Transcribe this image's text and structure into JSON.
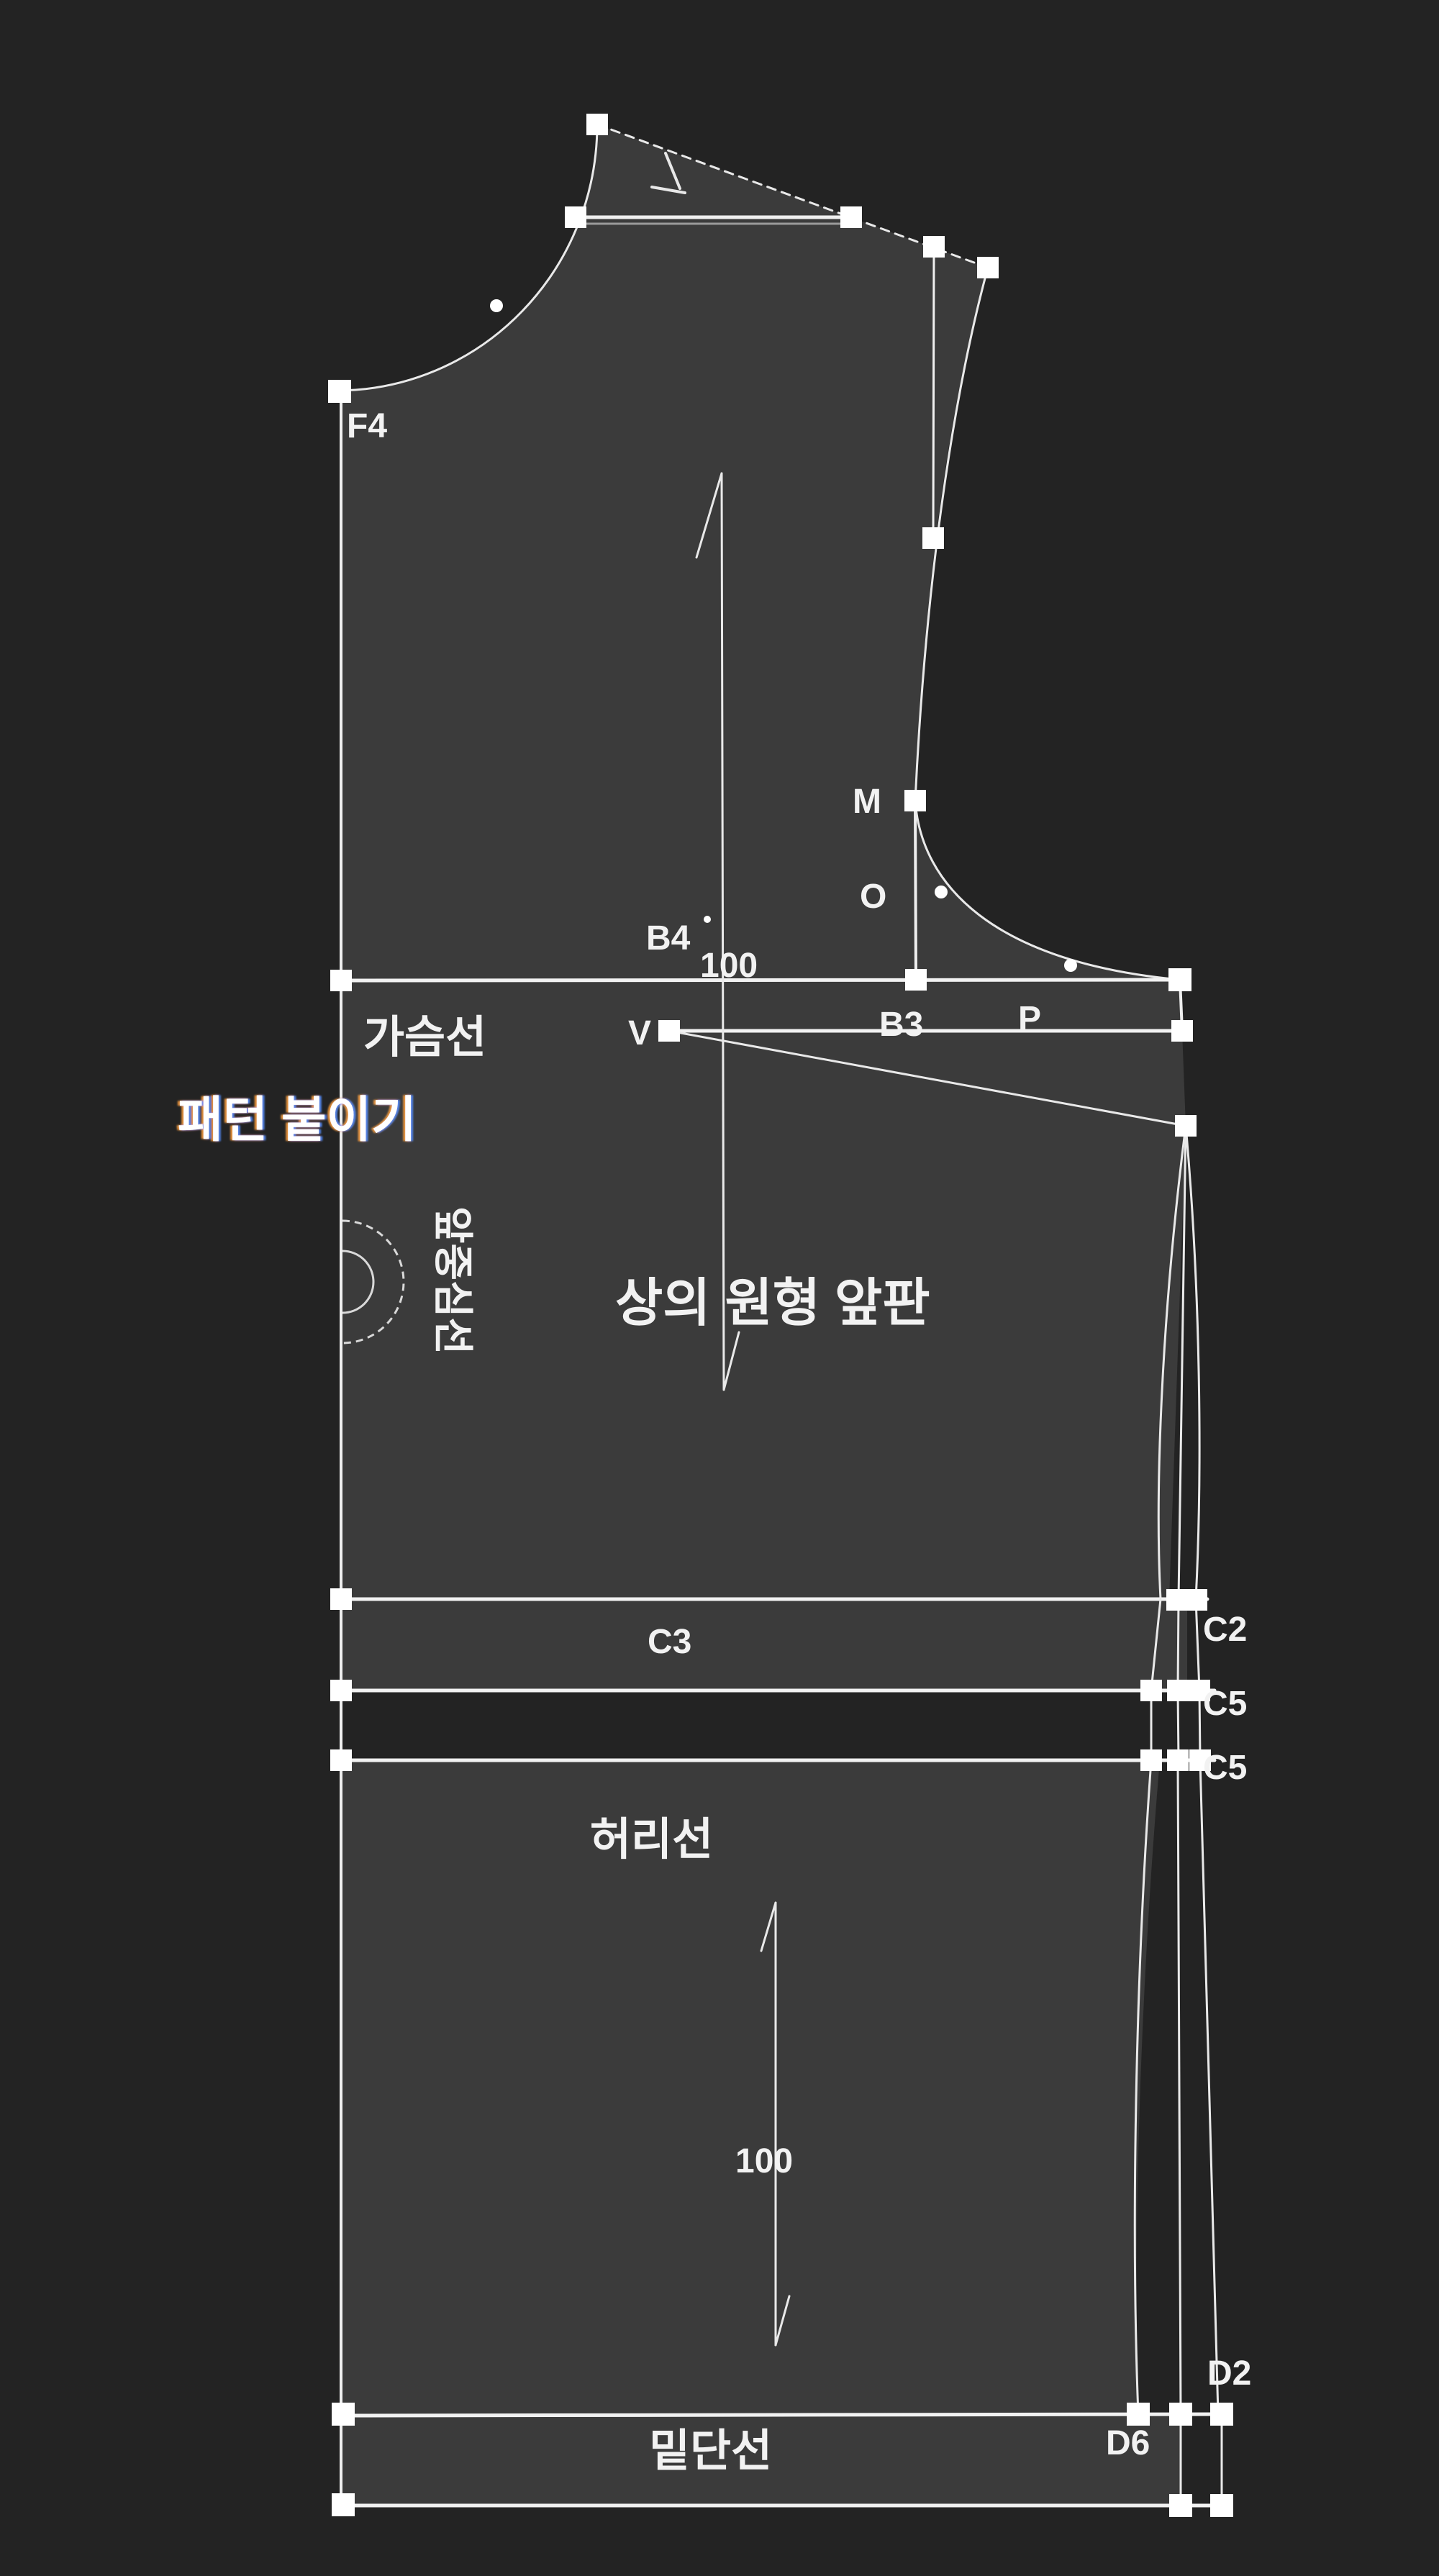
{
  "colors": {
    "background": "#232323",
    "pattern_fill": "#3b3b3b",
    "outline": "#f0f0f0",
    "guide_line": "#bdbdbd",
    "node": "#ffffff",
    "label_text": "#f2f2f2",
    "tooltip_fringe_warm": "#ffa040",
    "tooltip_fringe_cool": "#4c8dff"
  },
  "tooltip": {
    "text": "패턴 붙이기"
  },
  "pattern": {
    "title": "상의 원형 앞판",
    "lines": {
      "chest": "가슴선",
      "center_front": "앞중심선",
      "waist": "허리선",
      "hem": "밑단선"
    },
    "points": {
      "f4": "F4",
      "m": "M",
      "o": "O",
      "b4": "B4",
      "b3": "B3",
      "p": "P",
      "v": "V",
      "c3": "C3",
      "c2": "C2",
      "c5_upper": "C5",
      "c5_lower": "C5",
      "d2": "D2",
      "d6": "D6"
    },
    "grain": {
      "upper": "100",
      "lower": "100"
    }
  }
}
